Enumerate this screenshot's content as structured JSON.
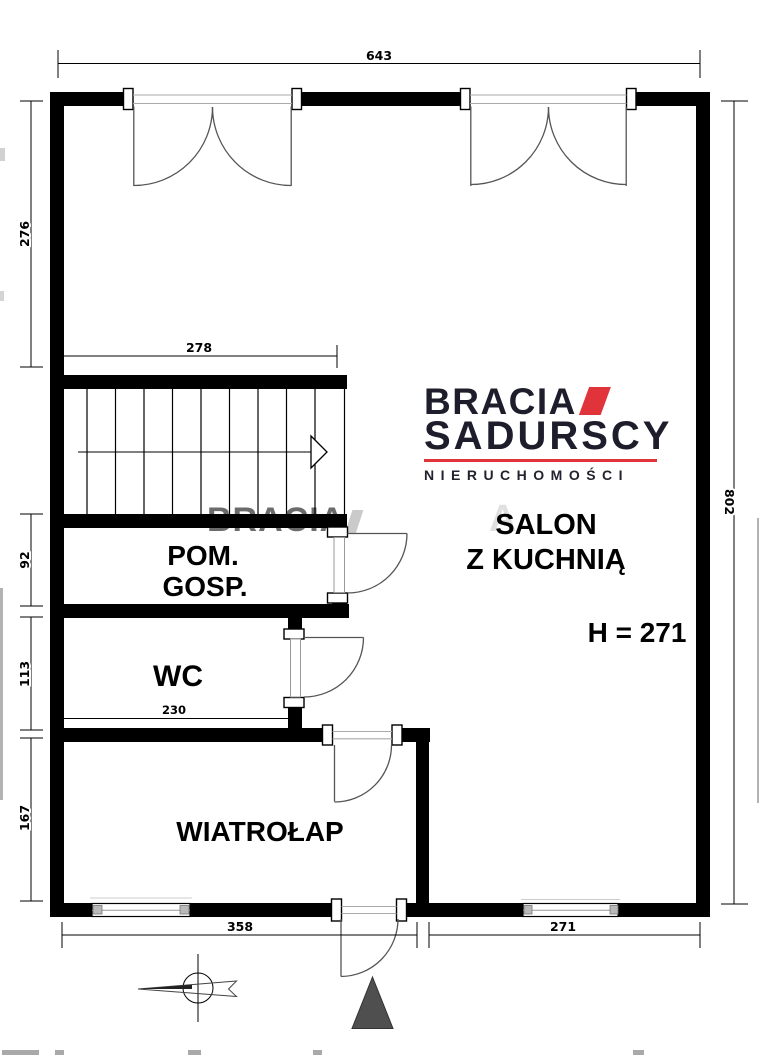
{
  "watermark": {
    "text": "BRACIA",
    "faint_letter": "A"
  },
  "logo": {
    "brand_top": "BRACIA",
    "brand_bottom": "SADURSCY",
    "tagline": "NIERUCHOMOŚCI",
    "accent_color": "#e1333a",
    "text_color": "#1d1d2b"
  },
  "rooms": {
    "pom_gosp_line1": "POM.",
    "pom_gosp_line2": "GOSP.",
    "wc": "WC",
    "wiatrolap": "WIATROŁAP",
    "salon_line1": "SALON",
    "salon_line2": "Z KUCHNIĄ",
    "ceiling_height": "H = 271"
  },
  "dimensions": {
    "top_width": "643",
    "upper_left_height": "276",
    "stairs_width": "278",
    "pom_gosp_height": "92",
    "wc_height": "113",
    "wiatrolap_height": "167",
    "wc_width": "230",
    "bottom_left_width": "358",
    "bottom_right_width": "271",
    "right_height": "802"
  }
}
